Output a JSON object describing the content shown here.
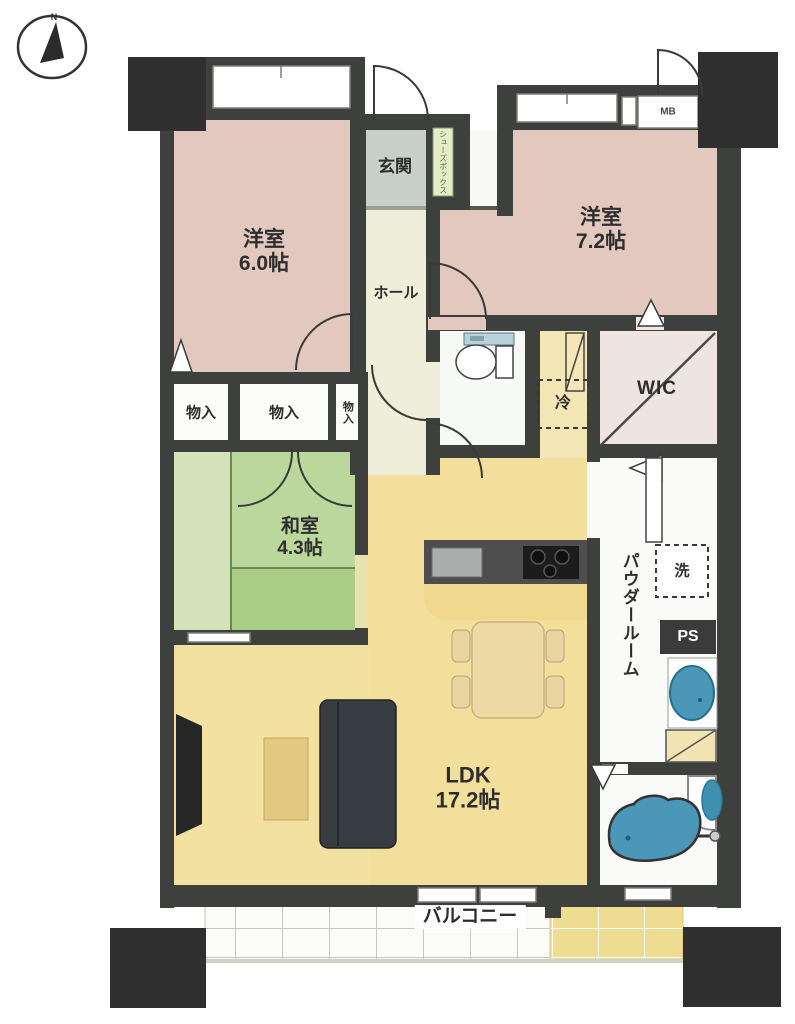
{
  "compass": {
    "north_label": "N"
  },
  "rooms": {
    "western1": {
      "name": "洋室",
      "size": "6.0帖"
    },
    "western2": {
      "name": "洋室",
      "size": "7.2帖"
    },
    "japanese": {
      "name": "和室",
      "size": "4.3帖"
    },
    "ldk": {
      "name": "LDK",
      "size": "17.2帖"
    },
    "entrance": {
      "label": "玄関"
    },
    "hall": {
      "label": "ホール"
    },
    "shoe_box": {
      "label": "シューズボックス"
    },
    "storage1": {
      "label": "物入"
    },
    "storage2": {
      "label": "物入"
    },
    "storage3": {
      "label": "物入"
    },
    "wic": {
      "label": "WIC"
    },
    "powder_room": {
      "label": "パウダールーム"
    },
    "balcony": {
      "label": "バルコニー"
    }
  },
  "fixtures": {
    "refrigerator": {
      "label": "冷"
    },
    "washer": {
      "label": "洗"
    },
    "pipe_space": {
      "label": "PS"
    },
    "meter_box": {
      "label": "MB"
    }
  },
  "palette": {
    "wall": "#3d403c",
    "pillar": "#2f2f2f",
    "western_room": "#e2c8be",
    "japanese_room": "#b9d69a",
    "ldk_floor": "#f3df9c",
    "hall_floor": "#efeeda",
    "entrance_floor": "#c9cfc9",
    "water_blue": "#4b97b8",
    "balcony_tile_yellow": "#eedc90"
  }
}
